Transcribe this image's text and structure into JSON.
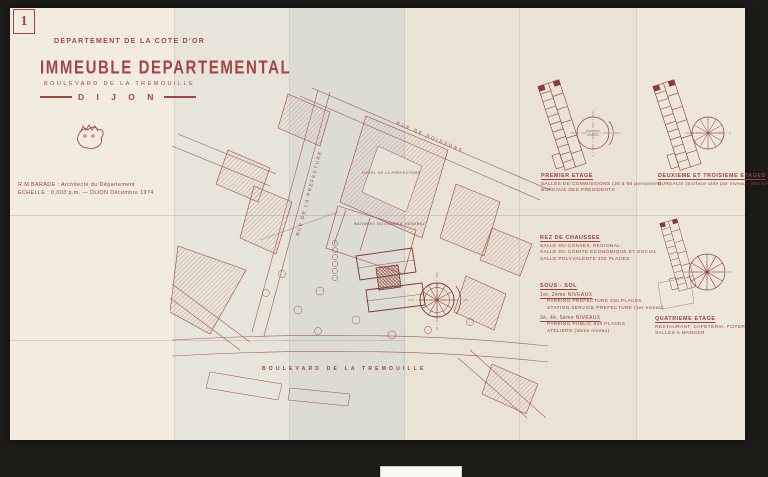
{
  "sheet": {
    "number": "1"
  },
  "title_block": {
    "department": "DEPARTEMENT DE LA COTE D'OR",
    "title": "IMMEUBLE DEPARTEMENTAL",
    "address": "BOULEVARD DE LA TREMOUILLE",
    "city": "D I J O N"
  },
  "credits": {
    "architect_line": "R.M.BARADE : Architecte du Département",
    "scale_line": "ECHELLE : 0,003 p.m. — DIJON Décembre 1974"
  },
  "site_plan": {
    "street_soissons": "RUE DE SOISSONS",
    "street_prefecture": "RUE DE LA PREFECTURE",
    "street_boulevard": "BOULEVARD DE LA TREMOUILLE",
    "building_prefecture": "HOTEL DE LA PREFECTURE",
    "building_conseil": "BATIMENT DU CONSEIL GENERAL"
  },
  "annotations": {
    "premier_etage": {
      "heading": "PREMIER ETAGE",
      "line1": "SALLES DE COMMISSIONS (26 à 56 personnes)",
      "line2": "BUREAUX DES PRESIDENTS"
    },
    "deuxieme_troisieme": {
      "heading": "DEUXIEME ET TROISIEME ETAGES",
      "line1": "BUREAUX (Surface utile par niveau : 954 m²)"
    },
    "rez_de_chaussee": {
      "heading": "REZ DE CHAUSSEE",
      "line1": "SALLE DU CONSEIL REGIONAL",
      "line2": "SALLE DU COMITE ECONOMIQUE ET SOCIAL",
      "line3": "SALLE POLYVALENTE 400 PLACES",
      "heading2": "SOUS - SOL",
      "level1": "1er, 2ème NIVEAUX",
      "level1_line1": "PARKING PREFECTURE 230 PLACES",
      "level1_line2": "STATION SERVICE PREFECTURE (1er niveau)",
      "level2": "3è, 4è, 5ème NIVEAUX",
      "level2_line1": "PARKING PUBLIC 510 PLACES",
      "level2_line2": "ATELIERS (3ème niveau)"
    },
    "quatrieme": {
      "heading": "QUATRIEME ETAGE",
      "line1": "RESTAURANT, CAFETERIA, FOYER,",
      "line2": "SALLES A MANGER"
    }
  },
  "colors": {
    "ink": "#95433f",
    "paper": "#ece6da",
    "mount": "#1c1b18"
  }
}
